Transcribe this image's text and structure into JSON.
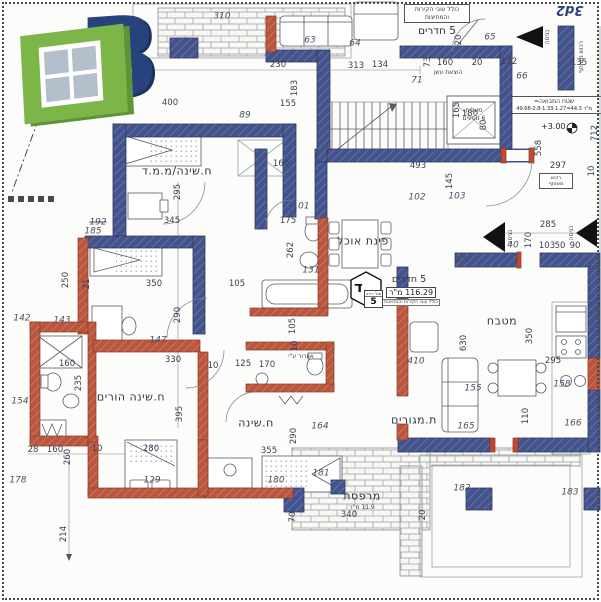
{
  "logo": {
    "letter": "B"
  },
  "stamp": "3d2",
  "plan": {
    "colors": {
      "wall_navy": "#41508a",
      "wall_red": "#b8563e",
      "paper": "#fcfcfa"
    },
    "top_apartment": {
      "note": "כולל עובי הקירות והמחיצות",
      "title": "5 חדרים"
    },
    "badge": {
      "letter": "ד",
      "title": "5 חדרים",
      "area": "116.29 מ\"ר",
      "note": "כולל עובי הקירות והמחיצות",
      "unit_label": "מס' דירה",
      "unit_number": "5"
    },
    "lobby_note": {
      "title": "שטח המבואה=",
      "formula": "49.68-2.8-1.33-1.27=44.3 מ\"ר"
    },
    "level_marker": "+3.00",
    "elevator": {
      "line1": "מעלית",
      "line2": "6 נוסעים"
    },
    "shaft_box": {
      "line1": "רכוש",
      "line2": "משותף"
    },
    "rooms": [
      {
        "label": "ח.שינה/מ.מ.ד",
        "x": 177,
        "y": 171
      },
      {
        "label": "פינת אוכל",
        "x": 363,
        "y": 241
      },
      {
        "label": "מטבח",
        "x": 502,
        "y": 321
      },
      {
        "label": "ח.שינה הורים",
        "x": 131,
        "y": 397
      },
      {
        "label": "ח.שינה",
        "x": 256,
        "y": 423
      },
      {
        "label": "ת.מגורים",
        "x": 414,
        "y": 420
      },
      {
        "label": "מרפסת",
        "x": 362,
        "y": 496
      }
    ],
    "annotations": [
      {
        "t": "11.9 מ\"ר",
        "x": 362,
        "y": 508
      },
      {
        "t": "הוצאת עשן",
        "x": 448,
        "y": 73
      },
      {
        "t": "אוורור ע\"י",
        "x": 301,
        "y": 357
      },
      {
        "t": "רכוש משותף",
        "x": 582,
        "y": 57,
        "r": -90
      },
      {
        "t": "כניסה",
        "x": 548,
        "y": 37,
        "r": -90
      },
      {
        "t": "כניסה",
        "x": 511,
        "y": 237,
        "r": -90
      },
      {
        "t": "כניסה",
        "x": 572,
        "y": 233,
        "r": -90
      }
    ],
    "dimensions": [
      {
        "t": "400",
        "x": 170,
        "y": 103
      },
      {
        "t": "155",
        "x": 288,
        "y": 104
      },
      {
        "t": "89",
        "x": 245,
        "y": 116,
        "i": 1
      },
      {
        "t": "183",
        "x": 295,
        "y": 88,
        "r": -90
      },
      {
        "t": "310",
        "x": 222,
        "y": 17,
        "i": 1
      },
      {
        "t": "50",
        "x": 148,
        "y": 66
      },
      {
        "t": "230",
        "x": 278,
        "y": 65
      },
      {
        "t": "134",
        "x": 380,
        "y": 65
      },
      {
        "t": "63",
        "x": 310,
        "y": 41,
        "i": 1
      },
      {
        "t": "313",
        "x": 356,
        "y": 66
      },
      {
        "t": "64",
        "x": 355,
        "y": 44,
        "i": 1
      },
      {
        "t": "20",
        "x": 459,
        "y": 40,
        "r": -90
      },
      {
        "t": "65",
        "x": 490,
        "y": 38,
        "i": 1
      },
      {
        "t": "73",
        "x": 428,
        "y": 62,
        "r": -90
      },
      {
        "t": "160",
        "x": 445,
        "y": 63
      },
      {
        "t": "20",
        "x": 477,
        "y": 63
      },
      {
        "t": "172",
        "x": 509,
        "y": 62
      },
      {
        "t": "66",
        "x": 522,
        "y": 77,
        "i": 1
      },
      {
        "t": "71",
        "x": 417,
        "y": 81,
        "i": 1
      },
      {
        "t": "135",
        "x": 579,
        "y": 63
      },
      {
        "t": "165",
        "x": 457,
        "y": 110,
        "r": -90
      },
      {
        "t": "180",
        "x": 470,
        "y": 114
      },
      {
        "t": "80",
        "x": 484,
        "y": 125,
        "r": -90
      },
      {
        "t": "558",
        "x": 539,
        "y": 148,
        "r": -90
      },
      {
        "t": "712",
        "x": 595,
        "y": 133,
        "r": -90
      },
      {
        "t": "493",
        "x": 418,
        "y": 166
      },
      {
        "t": "297",
        "x": 558,
        "y": 166
      },
      {
        "t": "10",
        "x": 592,
        "y": 171,
        "r": -90
      },
      {
        "t": "145",
        "x": 450,
        "y": 181,
        "r": -90
      },
      {
        "t": "102",
        "x": 417,
        "y": 198,
        "i": 1
      },
      {
        "t": "103",
        "x": 457,
        "y": 197,
        "i": 1
      },
      {
        "t": "285",
        "x": 548,
        "y": 225
      },
      {
        "t": "40",
        "x": 513,
        "y": 246,
        "i": 1
      },
      {
        "t": "170",
        "x": 529,
        "y": 240,
        "r": -90
      },
      {
        "t": "103",
        "x": 547,
        "y": 246
      },
      {
        "t": "50",
        "x": 560,
        "y": 246
      },
      {
        "t": "90",
        "x": 575,
        "y": 246
      },
      {
        "t": "127",
        "x": 463,
        "y": 261,
        "i": 1
      },
      {
        "t": "295",
        "x": 178,
        "y": 192,
        "r": -90
      },
      {
        "t": "345",
        "x": 172,
        "y": 221
      },
      {
        "t": "192",
        "x": 98,
        "y": 223,
        "i": 1,
        "s": 1
      },
      {
        "t": "185",
        "x": 93,
        "y": 232,
        "i": 1
      },
      {
        "t": "250",
        "x": 66,
        "y": 280,
        "r": -90
      },
      {
        "t": "350",
        "x": 154,
        "y": 284
      },
      {
        "t": "21",
        "x": 87,
        "y": 284,
        "r": -90
      },
      {
        "t": "290",
        "x": 178,
        "y": 315,
        "r": -90
      },
      {
        "t": "147",
        "x": 158,
        "y": 341,
        "i": 1
      },
      {
        "t": "330",
        "x": 173,
        "y": 360
      },
      {
        "t": "142",
        "x": 22,
        "y": 319,
        "i": 1
      },
      {
        "t": "143",
        "x": 62,
        "y": 321,
        "i": 1
      },
      {
        "t": "160",
        "x": 67,
        "y": 364
      },
      {
        "t": "235",
        "x": 79,
        "y": 383,
        "r": -90
      },
      {
        "t": "154",
        "x": 20,
        "y": 402,
        "i": 1
      },
      {
        "t": "395",
        "x": 180,
        "y": 414,
        "r": -90
      },
      {
        "t": "280",
        "x": 151,
        "y": 449
      },
      {
        "t": "10",
        "x": 97,
        "y": 449
      },
      {
        "t": "260",
        "x": 68,
        "y": 457,
        "r": -90
      },
      {
        "t": "160",
        "x": 55,
        "y": 450
      },
      {
        "t": "28",
        "x": 33,
        "y": 450
      },
      {
        "t": "178",
        "x": 18,
        "y": 481,
        "i": 1
      },
      {
        "t": "129",
        "x": 152,
        "y": 481,
        "i": 1
      },
      {
        "t": "214",
        "x": 64,
        "y": 534,
        "r": -90
      },
      {
        "t": "160",
        "x": 281,
        "y": 164
      },
      {
        "t": "101",
        "x": 301,
        "y": 207,
        "i": 1
      },
      {
        "t": "175",
        "x": 288,
        "y": 221
      },
      {
        "t": "262",
        "x": 291,
        "y": 250,
        "r": -90
      },
      {
        "t": "131",
        "x": 311,
        "y": 271,
        "i": 1
      },
      {
        "t": "105",
        "x": 237,
        "y": 284
      },
      {
        "t": "105",
        "x": 293,
        "y": 326,
        "r": -90
      },
      {
        "t": "10",
        "x": 295,
        "y": 346,
        "r": -90
      },
      {
        "t": "125",
        "x": 243,
        "y": 364
      },
      {
        "t": "10",
        "x": 213,
        "y": 366
      },
      {
        "t": "170",
        "x": 267,
        "y": 365
      },
      {
        "t": "164",
        "x": 320,
        "y": 427,
        "i": 1
      },
      {
        "t": "290",
        "x": 294,
        "y": 436,
        "r": -90
      },
      {
        "t": "355",
        "x": 269,
        "y": 451
      },
      {
        "t": "180",
        "x": 276,
        "y": 481,
        "i": 1
      },
      {
        "t": "181",
        "x": 321,
        "y": 474,
        "i": 1
      },
      {
        "t": "340",
        "x": 349,
        "y": 515
      },
      {
        "t": "70",
        "x": 293,
        "y": 517,
        "r": -90
      },
      {
        "t": "630",
        "x": 464,
        "y": 343,
        "r": -90
      },
      {
        "t": "410",
        "x": 416,
        "y": 362,
        "i": 1
      },
      {
        "t": "350",
        "x": 530,
        "y": 336,
        "r": -90
      },
      {
        "t": "295",
        "x": 553,
        "y": 361
      },
      {
        "t": "155",
        "x": 473,
        "y": 389,
        "i": 1
      },
      {
        "t": "158",
        "x": 562,
        "y": 385,
        "i": 1
      },
      {
        "t": "165",
        "x": 466,
        "y": 427,
        "i": 1
      },
      {
        "t": "110",
        "x": 526,
        "y": 416,
        "r": -90
      },
      {
        "t": "166",
        "x": 573,
        "y": 424,
        "i": 1
      },
      {
        "t": "182",
        "x": 462,
        "y": 489,
        "i": 1
      },
      {
        "t": "20",
        "x": 423,
        "y": 515,
        "r": -90
      },
      {
        "t": "183",
        "x": 570,
        "y": 493,
        "i": 1
      }
    ]
  }
}
